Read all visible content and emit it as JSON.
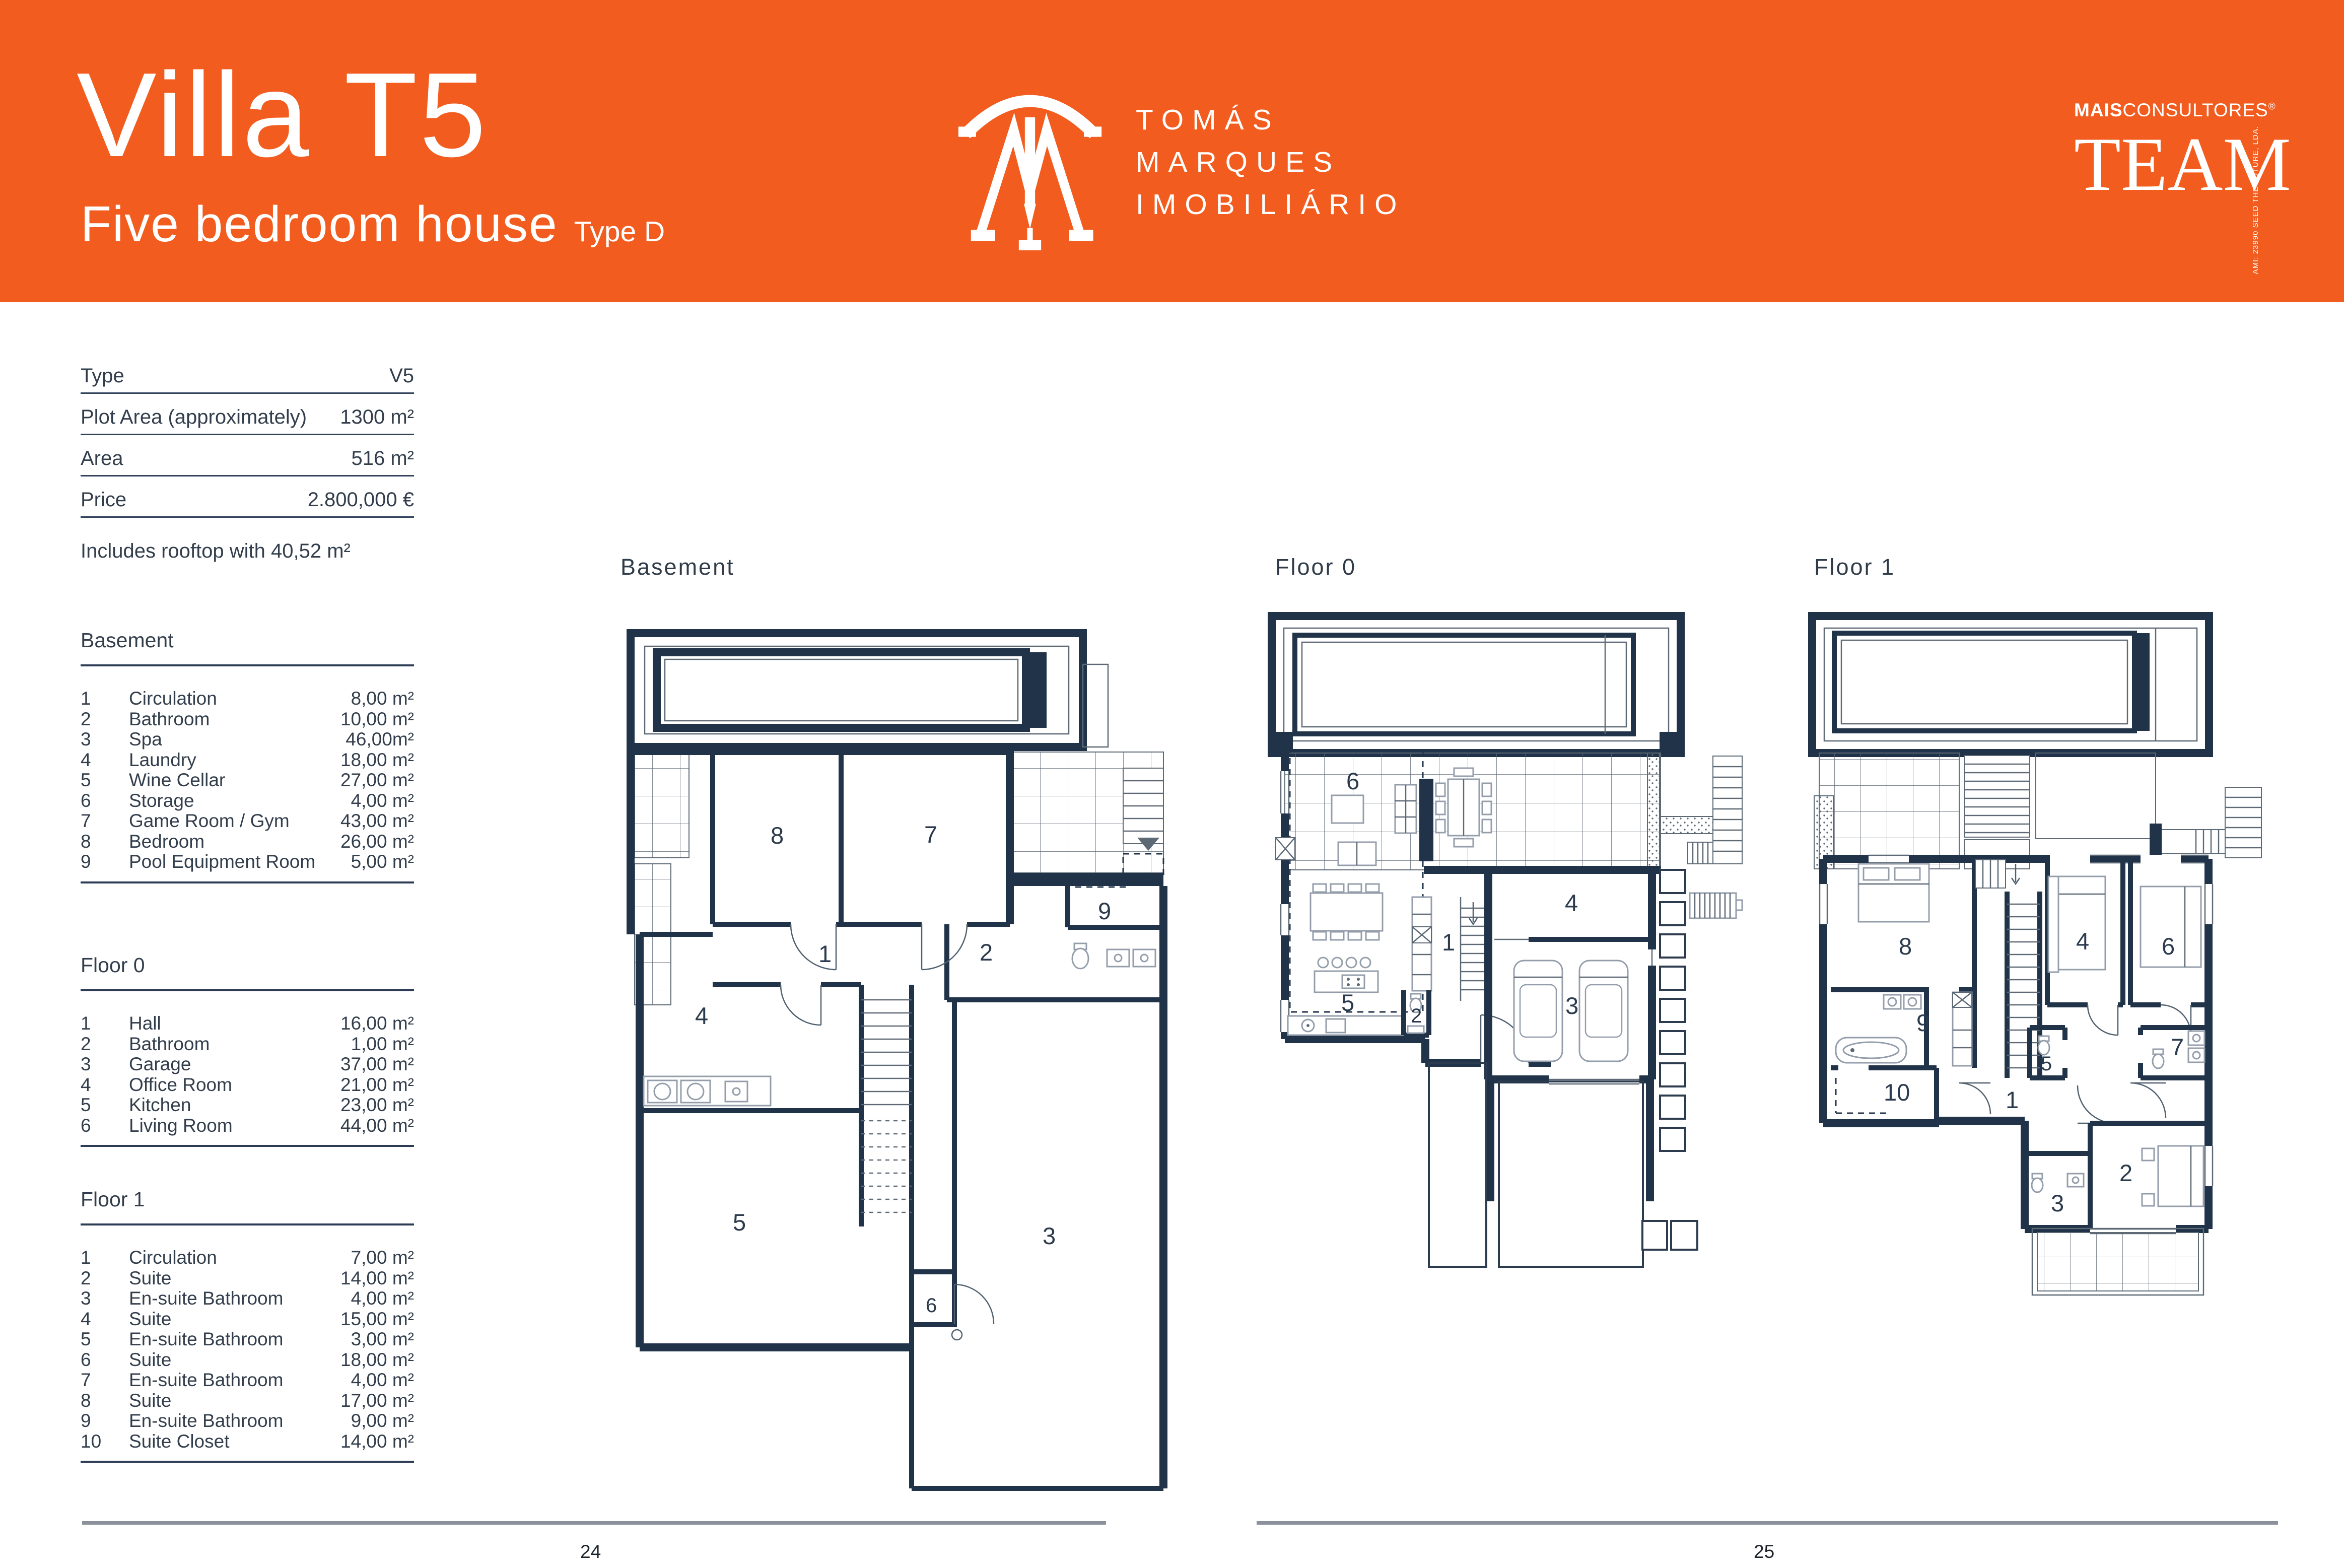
{
  "header": {
    "title": "Villa T5",
    "subtitle": "Five bedroom house",
    "type_label": "Type D",
    "accent_color": "#F25C1F",
    "brand": {
      "monogram_icon": "tm-monogram-icon",
      "line1": "TOMÁS",
      "line2": "MARQUES",
      "line3": "IMOBILIÁRIO"
    },
    "team_logo": {
      "prefix_bold": "MAIS",
      "prefix_rest": "CONSULTORES",
      "registered_mark": "®",
      "name": "TEAM",
      "side_text": "AMI: 23990   SEED THE FUTURE, LDA."
    }
  },
  "info_table": {
    "rows": [
      {
        "label": "Type",
        "value": "V5"
      },
      {
        "label": "Plot Area (approximately)",
        "value": "1300 m²"
      },
      {
        "label": "Area",
        "value": "516 m²"
      },
      {
        "label": "Price",
        "value": "2.800,000 €"
      }
    ],
    "note": "Includes rooftop with 40,52 m²"
  },
  "sections": [
    {
      "title": "Basement",
      "rooms": [
        {
          "num": "1",
          "name": "Circulation",
          "area": "8,00 m²"
        },
        {
          "num": "2",
          "name": "Bathroom",
          "area": "10,00 m²"
        },
        {
          "num": "3",
          "name": "Spa",
          "area": "46,00m²"
        },
        {
          "num": "4",
          "name": "Laundry",
          "area": "18,00 m²"
        },
        {
          "num": "5",
          "name": "Wine Cellar",
          "area": "27,00 m²"
        },
        {
          "num": "6",
          "name": "Storage",
          "area": "4,00 m²"
        },
        {
          "num": "7",
          "name": "Game Room / Gym",
          "area": "43,00 m²"
        },
        {
          "num": "8",
          "name": "Bedroom",
          "area": "26,00 m²"
        },
        {
          "num": "9",
          "name": "Pool Equipment Room",
          "area": "5,00 m²"
        }
      ]
    },
    {
      "title": "Floor 0",
      "rooms": [
        {
          "num": "1",
          "name": "Hall",
          "area": "16,00 m²"
        },
        {
          "num": "2",
          "name": "Bathroom",
          "area": "1,00 m²"
        },
        {
          "num": "3",
          "name": "Garage",
          "area": "37,00 m²"
        },
        {
          "num": "4",
          "name": "Office Room",
          "area": "21,00 m²"
        },
        {
          "num": "5",
          "name": "Kitchen",
          "area": "23,00 m²"
        },
        {
          "num": "6",
          "name": "Living Room",
          "area": "44,00 m²"
        }
      ]
    },
    {
      "title": "Floor 1",
      "rooms": [
        {
          "num": "1",
          "name": "Circulation",
          "area": "7,00 m²"
        },
        {
          "num": "2",
          "name": "Suite",
          "area": "14,00 m²"
        },
        {
          "num": "3",
          "name": "En-suite Bathroom",
          "area": "4,00 m²"
        },
        {
          "num": "4",
          "name": "Suite",
          "area": "15,00 m²"
        },
        {
          "num": "5",
          "name": "En-suite Bathroom",
          "area": "3,00 m²"
        },
        {
          "num": "6",
          "name": "Suite",
          "area": "18,00 m²"
        },
        {
          "num": "7",
          "name": "En-suite Bathroom",
          "area": "4,00 m²"
        },
        {
          "num": "8",
          "name": "Suite",
          "area": "17,00 m²"
        },
        {
          "num": "9",
          "name": "En-suite Bathroom",
          "area": "9,00 m²"
        },
        {
          "num": "10",
          "name": "Suite Closet",
          "area": "14,00 m²"
        }
      ]
    }
  ],
  "plans": {
    "wall_color": "#203349",
    "basement_title": "Basement",
    "floor0_title": "Floor 0",
    "floor1_title": "Floor 1"
  },
  "footer": {
    "page_left": "24",
    "page_right": "25",
    "rule_color": "#8B919B"
  }
}
